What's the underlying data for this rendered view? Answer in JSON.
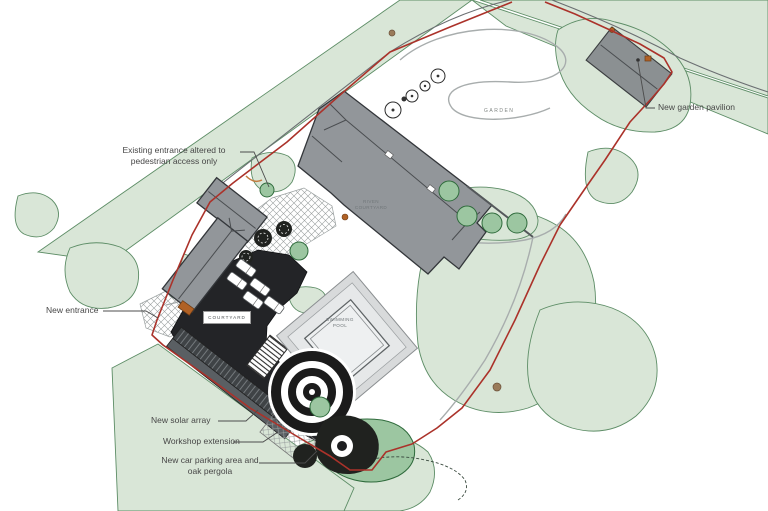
{
  "plan": {
    "annotations": {
      "existing_entrance_l1": "Existing entrance altered to",
      "existing_entrance_l2": "pedestrian access only",
      "new_entrance": "New entrance",
      "new_solar_array": "New solar array",
      "workshop_extension": "Workshop extension",
      "car_parking_l1": "New car parking area and",
      "car_parking_l2": "oak pergola",
      "garden_pavilion": "New garden pavilion"
    },
    "area_labels": {
      "garden": "GARDEN",
      "courtyard": "COURTYARD",
      "riven_courtyard_l1": "RIVEN",
      "riven_courtyard_l2": "COURTYARD",
      "pool_l1": "SWIMMING",
      "pool_l2": "POOL"
    },
    "colors": {
      "boundary_red": "#ab322a",
      "vegetation_light": "#d9e6d7",
      "vegetation_mid": "#9cc6a1",
      "vegetation_outline": "#5d8d66",
      "building_grey": "#92969a",
      "paving_black": "#232427",
      "accent_orange": "#b06125"
    }
  }
}
